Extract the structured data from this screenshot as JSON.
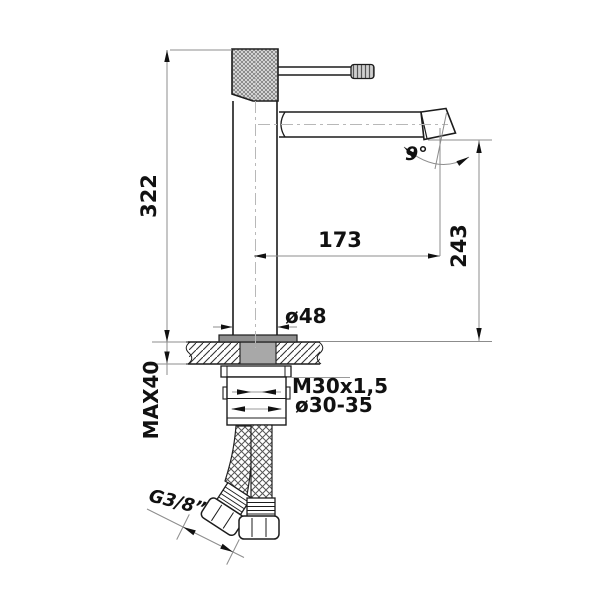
{
  "drawing": {
    "kind": "faucet-installation-dimension-drawing",
    "labels": {
      "overall_height": "322",
      "spout_reach": "173",
      "outlet_height": "243",
      "outlet_angle": "9°",
      "base_diameter": "ø48",
      "mounting_thread": "M30x1,5",
      "mounting_hole": "ø30-35",
      "max_deck_thickness": "MAX40",
      "hose_connection": "G3/8”"
    },
    "colors": {
      "line": "#1c1c1c",
      "dimension_line": "#8c8c8c",
      "centerline": "#b8b8b8",
      "shank_fill": "#a8a8a8",
      "baseplate_fill": "#8f8f8f"
    }
  }
}
